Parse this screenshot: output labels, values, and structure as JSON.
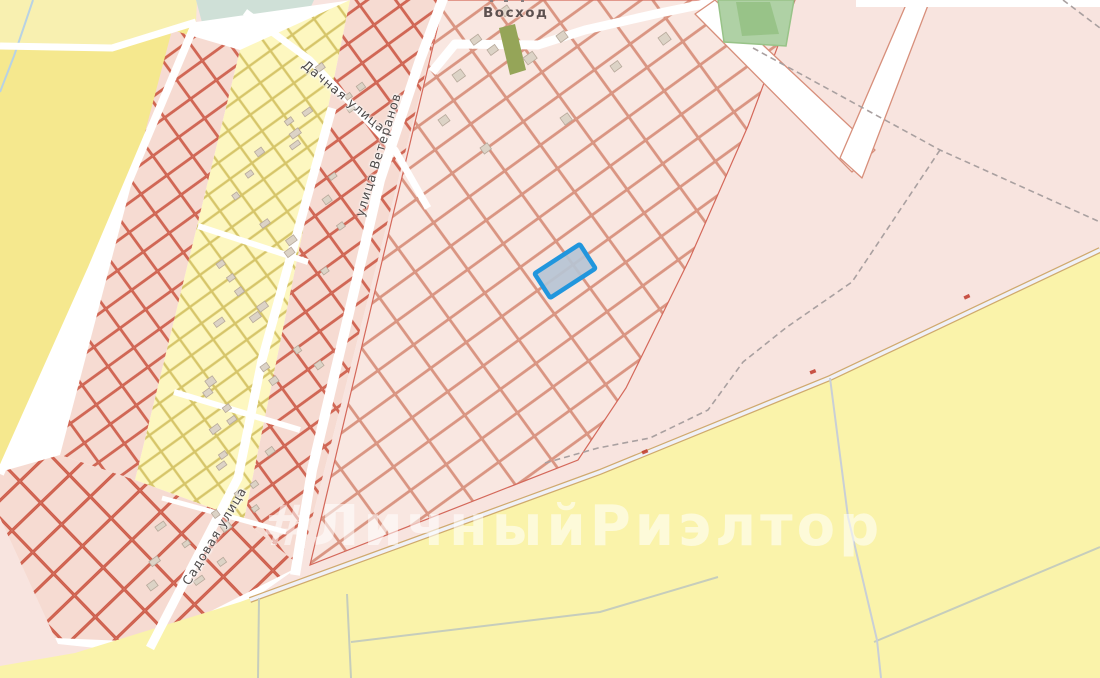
{
  "map": {
    "place_label": "Восход",
    "streets": [
      {
        "label": "Дачная улица"
      },
      {
        "label": "улица Ветеранов"
      },
      {
        "label": "Садовая улица"
      }
    ],
    "watermark": "#ЛичныйРиэлтор",
    "theme": {
      "pinkBase": "#f8e4df",
      "yellowTopPale": "#f8f0b0",
      "yellowTopDeep": "#f5e88e",
      "yellowBottom": "#faf3aa",
      "teal": "#cfe0d7",
      "greenPark": "#afd1a5",
      "greenParkDark": "#98c388",
      "greenStrip": "#95a558",
      "roadWhite": "#ffffff",
      "roadCasing": "#cfa96e",
      "roadInner": "#f0f1f7",
      "parcelPinkFill": "#f9e7e1",
      "parcelPinkStroke": "#d78f7b",
      "parcelRedFill": "#f6dbd2",
      "parcelRedStroke": "#cd5b48",
      "parcelYellowFill": "#fdf7c0",
      "parcelYellowStroke": "#d6c569",
      "buildingFill": "#dcd3c6",
      "buildingStroke": "#b7a99b",
      "selectedFill": "#b6c4d4",
      "selectedStroke": "#2196dd",
      "labelColor": "#4e4a49",
      "placeLabelColor": "#5d5150",
      "watermarkColor": "rgba(255,255,255,0.55)",
      "dashedBoundary": "#a9a0a0",
      "pathGreen": "#c6cdbc",
      "pathBlue": "#c9cfd6",
      "creek": "#b8d2e4",
      "redBoundary": "#d4685a",
      "markerRed": "#c0392b"
    }
  }
}
